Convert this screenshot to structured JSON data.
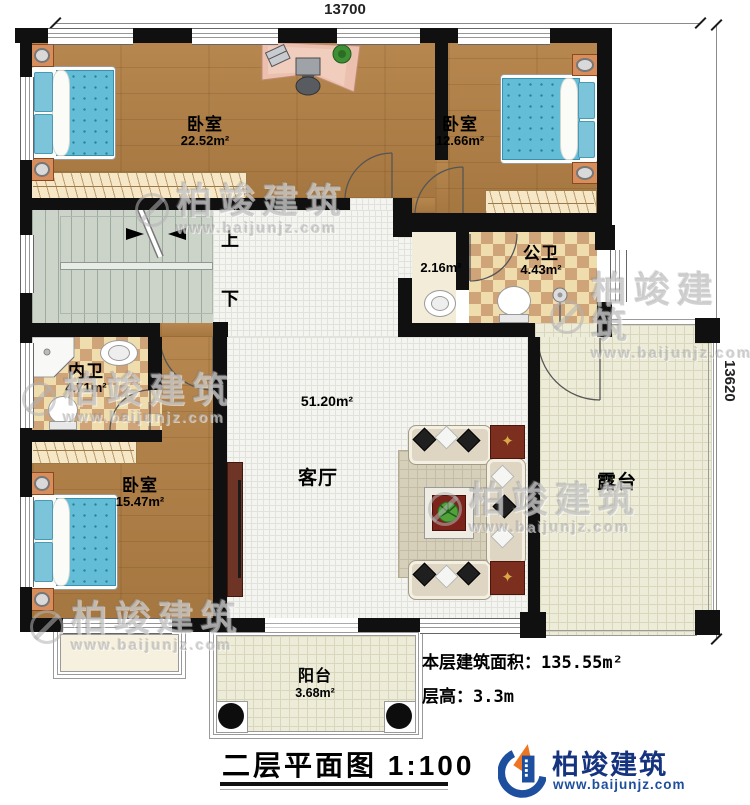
{
  "dimensions": {
    "top": "13700",
    "right": "13620"
  },
  "rooms": {
    "bedroom_top_left": {
      "name": "卧室",
      "area": "22.52m²"
    },
    "bedroom_top_right": {
      "name": "卧室",
      "area": "12.66m²"
    },
    "bedroom_bottom_left": {
      "name": "卧室",
      "area": "15.47m²"
    },
    "public_bathroom": {
      "name": "公卫",
      "area": "4.43m²"
    },
    "wash_alcove": {
      "area": "2.16m²"
    },
    "private_bathroom": {
      "name": "内卫",
      "area": "4.71m²"
    },
    "living_room": {
      "name": "客厅",
      "area": "51.20m²"
    },
    "terrace": {
      "name": "露台"
    },
    "balcony": {
      "name": "阳台",
      "area": "3.68m²"
    }
  },
  "stairs": {
    "up": "上",
    "down": "下"
  },
  "notes": {
    "floor_area_label": "本层建筑面积：",
    "floor_area_value": "135.55m²",
    "floor_height_label": "层高：",
    "floor_height_value": "3.3m"
  },
  "title": {
    "text": "二层平面图",
    "scale": "1:100"
  },
  "logo": {
    "name": "柏竣建筑",
    "website": "www.baijunjz.com"
  },
  "watermark": {
    "brand": "柏竣建筑",
    "website": "www.baijunjz.com"
  },
  "colors": {
    "wall": "#101010",
    "wood_floor": "#b28045",
    "tile": "#f4f4f1",
    "outdoor_tile": "#edecd9",
    "checker_light": "#f0ddae",
    "checker_dark": "#cfa478",
    "stairs": "#ccd3c9",
    "bed_blue": "#64bdd6",
    "logo_blue": "#16337f",
    "logo_orange": "#ee7622"
  }
}
